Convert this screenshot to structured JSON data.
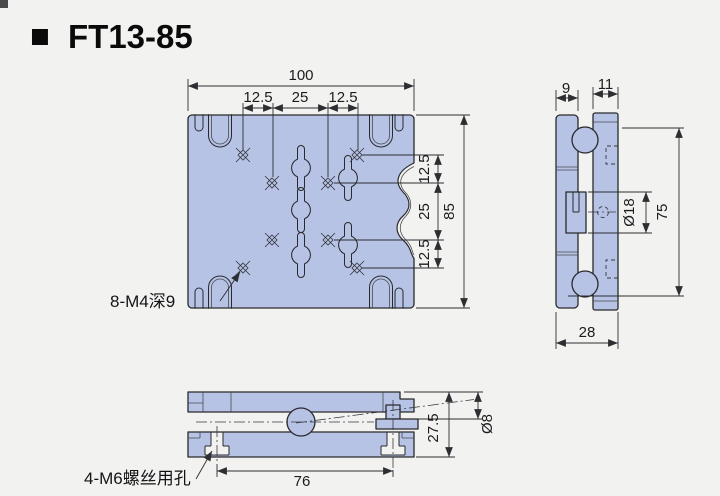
{
  "title": {
    "bullet": "■",
    "model": "FT13-85"
  },
  "front_view": {
    "dim_width": "100",
    "top_chain": [
      "12.5",
      "25",
      "12.5"
    ],
    "right_chain": [
      "12.5",
      "25",
      "12.5"
    ],
    "dim_height": "85",
    "thread_label": "8-M4深9"
  },
  "side_view": {
    "dim_front_plate_thickness": "9",
    "dim_back_plate_thickness": "11",
    "dim_knob_diameter": "Ø18",
    "dim_vertical_span": "75",
    "dim_total_thickness": "28"
  },
  "bottom_view": {
    "dim_hole_spacing": "76",
    "dim_assembly_height": "27.5",
    "dim_shaft_diameter": "Ø8",
    "screw_hole_label": "4-M6螺丝用孔"
  },
  "colors": {
    "plate": "#b6c3e5",
    "background": "#f2f2f0",
    "line": "#2a2a2e"
  }
}
